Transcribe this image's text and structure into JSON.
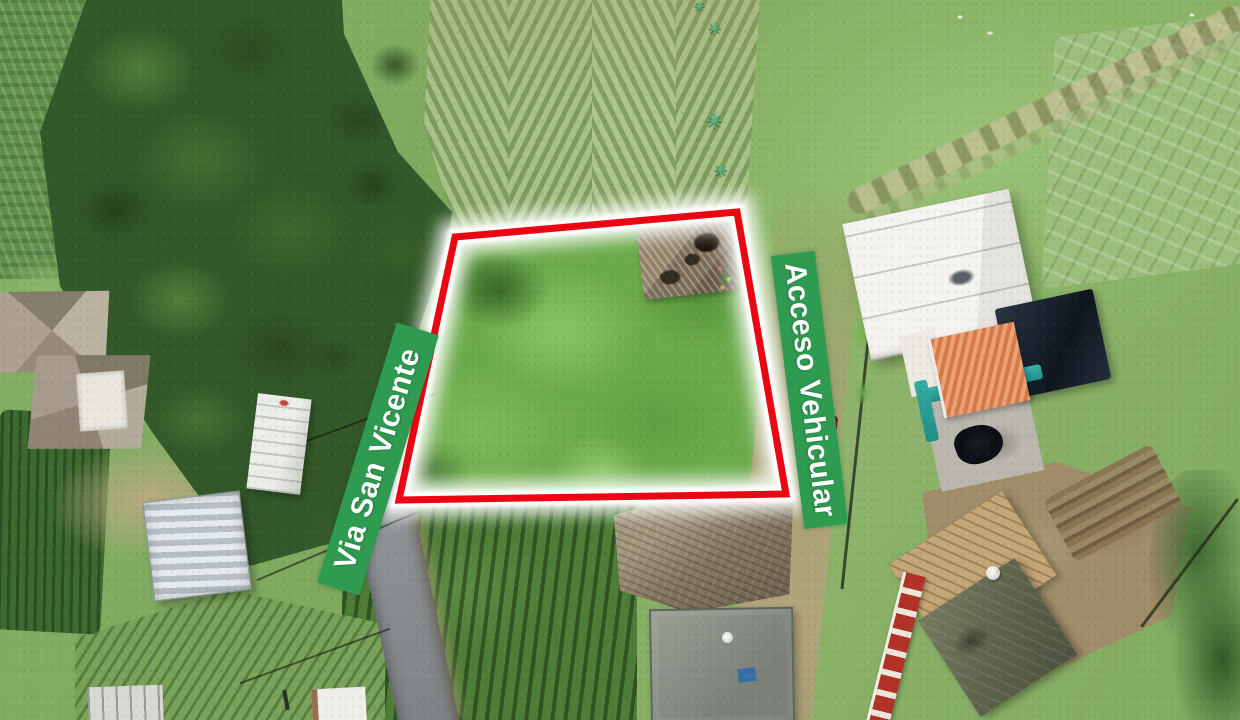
{
  "scene": {
    "description": "Aerial drone photograph of a rural land lot outlined for sale",
    "road_banner": {
      "label": "Via San Vicente"
    },
    "access_banner": {
      "label": "Acceso Vehicular"
    }
  },
  "colors": {
    "banner_green": "#2f9b51",
    "boundary_red": "#ea0713",
    "glow_white": "#ffffff"
  }
}
